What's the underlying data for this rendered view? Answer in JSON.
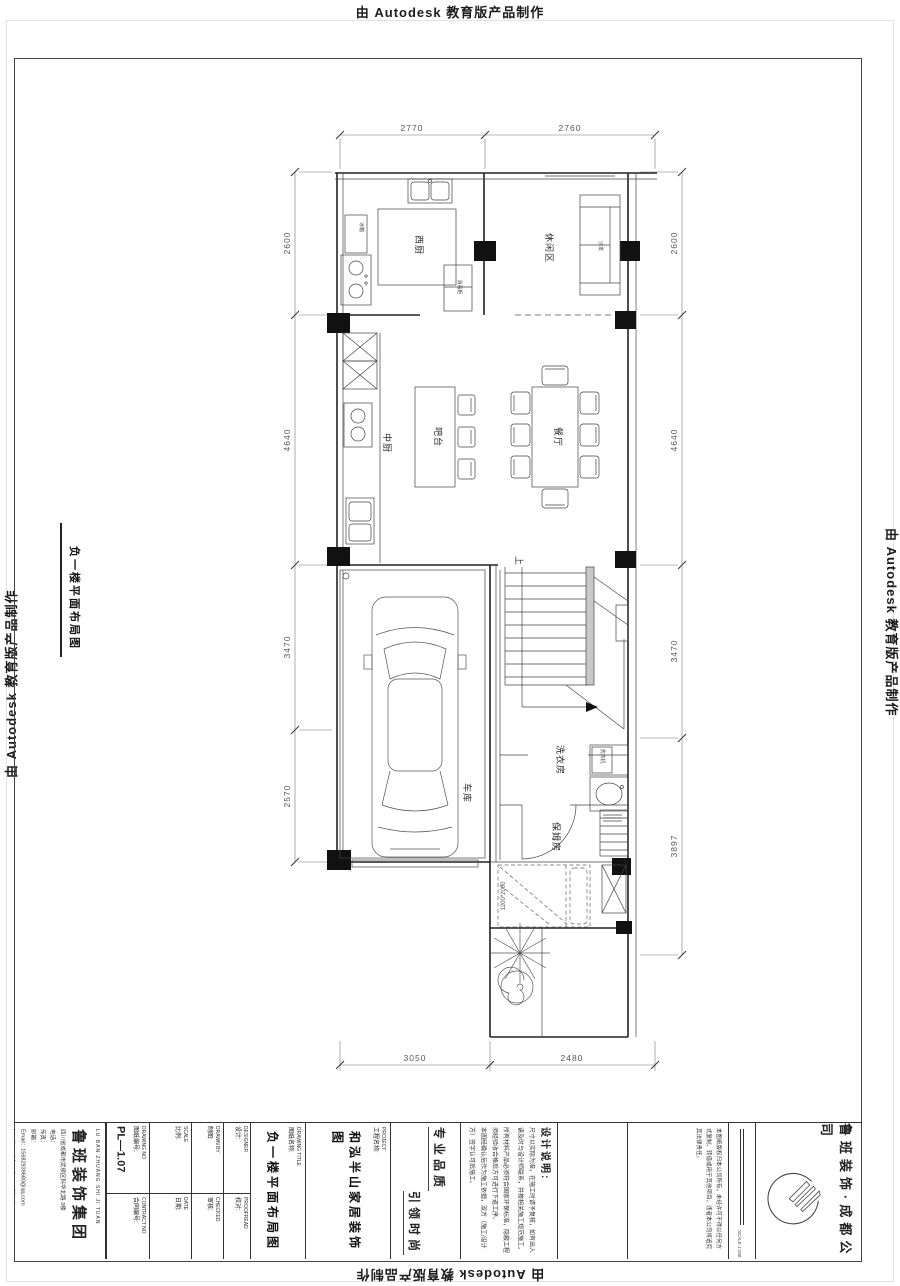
{
  "stamp": {
    "text": "由 Autodesk 教育版产品制作"
  },
  "sheet": {
    "title": "负一楼平面布局图"
  },
  "plan": {
    "rooms": {
      "west_kitchen": "西厨",
      "leisure": "休闲区",
      "chinese_kitchen": "中厨",
      "bar": "吧台",
      "dining": "餐厅",
      "garage": "车库",
      "laundry": "洗衣房",
      "nanny": "保姆房"
    },
    "labels": {
      "up": "上",
      "bed_size": "1200*2000",
      "sofa": "沙发",
      "fridge": "冰箱",
      "cabinet": "消毒柜",
      "washer": "洗衣机"
    },
    "dims": {
      "top": [
        "2770",
        "2760"
      ],
      "left": [
        "2600",
        "4640",
        "3470",
        "2570"
      ],
      "right": [
        "2600",
        "4640",
        "3470",
        "3897"
      ],
      "bottom": [
        "3050",
        "2480"
      ]
    }
  },
  "title_block": {
    "company": {
      "name_cn": "鲁班装饰集团",
      "name_en": "LU BAN ZHUANG SHI JI TUAN",
      "address": "四川省成都市武侯区科华北路 3楼",
      "tel": "电话：",
      "fax": "传真：",
      "mail": "邮箱：",
      "email": "Email：15682939680@qq.com",
      "site": "http://www.lubanzhuangshi.cn/"
    },
    "fields": [
      {
        "en": "DRAWING NO",
        "cn": "图纸编号:",
        "value": "PL—1.07"
      },
      {
        "en": "SCALE",
        "cn": "比例:",
        "value": ""
      },
      {
        "en": "DRAWN BY",
        "cn": "制图:",
        "value": ""
      },
      {
        "en": "DESIGNER",
        "cn": "设计:",
        "value": ""
      },
      {
        "en": "CONTRACT NO",
        "cn": "合同编号:",
        "value": ""
      },
      {
        "en": "DATE",
        "cn": "日期:",
        "value": ""
      },
      {
        "en": "CHECKED",
        "cn": "审核:",
        "value": ""
      },
      {
        "en": "PROOFREAD",
        "cn": "校对:",
        "value": ""
      }
    ],
    "drawing_title": {
      "en": "DRAWING TITLE",
      "cn": "图纸名称:",
      "value": "负一楼平面布局图"
    },
    "project": {
      "en": "PROJECT",
      "cn": "工程名称:",
      "value": "和泓半山家居装饰图"
    },
    "slogans": [
      "专业品质",
      "引领时尚"
    ],
    "notes": {
      "title": "设计说明:",
      "items": [
        "尺寸以实际为准，在施工时请予复核，如有出入请及时与设计师联系，并按相关施工规范施工。",
        "所有材料产品必须符合国家环保标准，隐蔽工程须经验收合格后方可进行下道工序。",
        "本图经确认后作为施工依据，双方（施工/设计方）签字认可后施工。"
      ]
    },
    "copyright": "本图纸版权归本公司所有，未经许可不得以任何方式复制、转借或用于其他项目，违者本公司将追究其法律责任。",
    "scale_note": "SCALE 1:100",
    "brand": "鲁班装饰·成都公司"
  }
}
